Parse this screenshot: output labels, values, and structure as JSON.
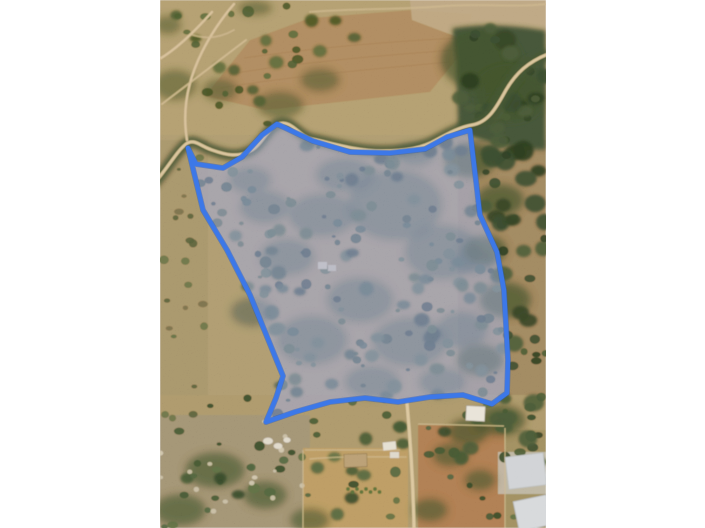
{
  "window": {
    "background_color": "#ffffff",
    "width_px": 705,
    "height_px": 528
  },
  "map": {
    "view_type": "satellite-aerial-photo",
    "content_description": "Aerial view of a rural scrubland parcel bordered by a tree-lined dirt road at top and farm fields with buildings and greenhouses at bottom; the parcel boundary is highlighted with a blue outline and translucent fill.",
    "image_area": {
      "left": 160,
      "top": 0,
      "width": 386,
      "height": 528
    },
    "parcel_overlay": {
      "stroke_color": "#3c78e8",
      "halo_color": "#2b5dc4",
      "stroke_width": 4.4,
      "fill_color": "rgba(138,152,210,0.42)",
      "ground_tint": "#93897f",
      "points": [
        [
          28,
          148
        ],
        [
          36,
          164
        ],
        [
          63,
          168
        ],
        [
          82,
          157
        ],
        [
          102,
          135
        ],
        [
          117,
          124
        ],
        [
          153,
          141
        ],
        [
          190,
          152
        ],
        [
          230,
          153
        ],
        [
          265,
          149
        ],
        [
          287,
          137
        ],
        [
          310,
          130
        ],
        [
          320,
          215
        ],
        [
          337,
          252
        ],
        [
          344,
          290
        ],
        [
          348,
          360
        ],
        [
          347,
          393
        ],
        [
          332,
          404
        ],
        [
          303,
          395
        ],
        [
          270,
          397
        ],
        [
          238,
          402
        ],
        [
          205,
          398
        ],
        [
          170,
          402
        ],
        [
          135,
          412
        ],
        [
          106,
          422
        ],
        [
          116,
          398
        ],
        [
          123,
          376
        ],
        [
          90,
          295
        ],
        [
          67,
          250
        ],
        [
          43,
          210
        ]
      ]
    },
    "palette": {
      "scrub_ground": "#9c8763",
      "plowed_field": "#9d7754",
      "dirt_road": "#d2b88a",
      "dense_trees": "#3a4a2d",
      "red_field": "#9d6c48",
      "bottom_scrub": "#8d7e66",
      "greenhouse_roof": "#c6cacf"
    }
  }
}
